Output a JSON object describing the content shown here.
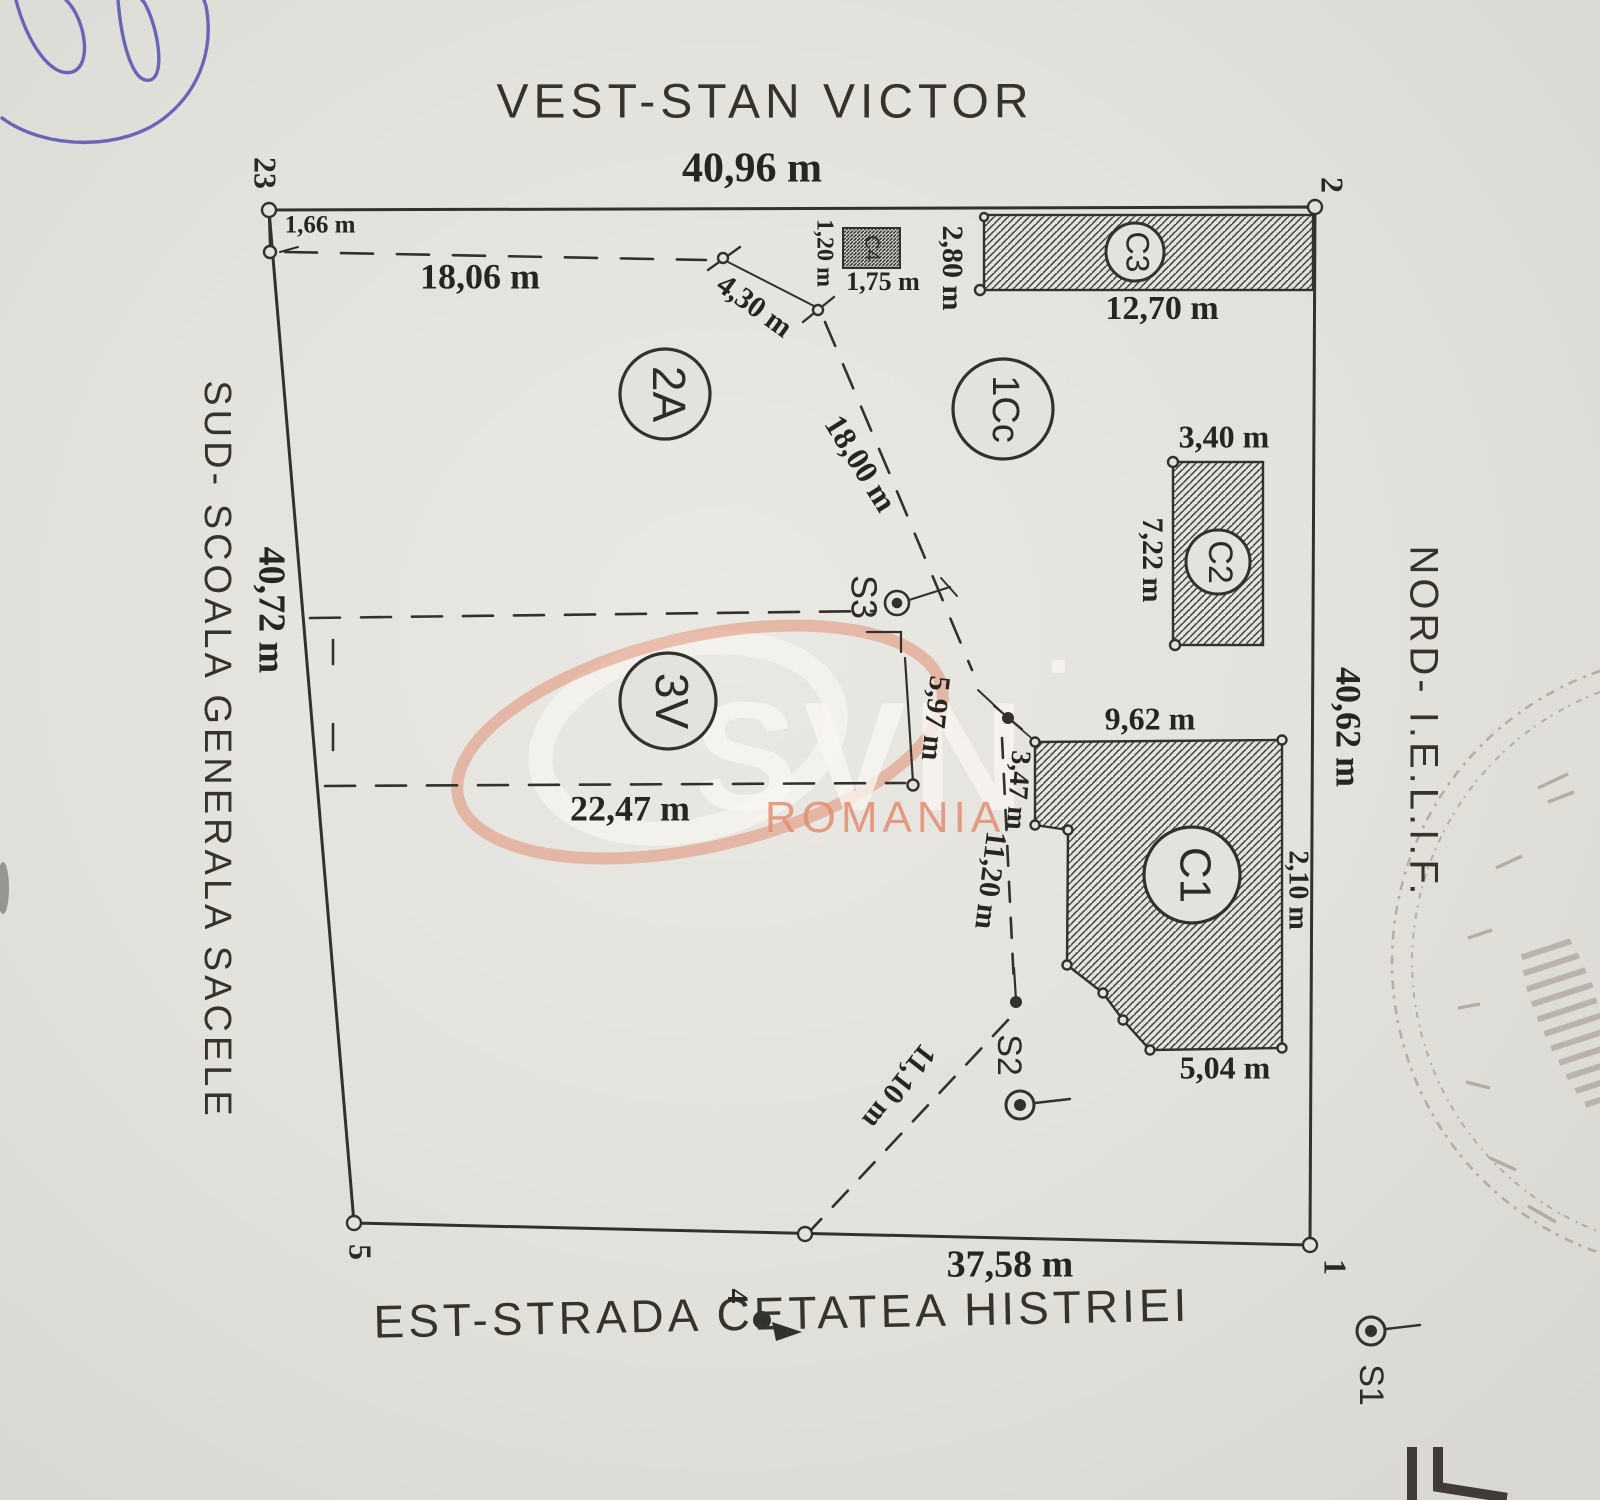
{
  "document": {
    "type_label": "cadastral plan scan",
    "paper_color": "#e3e1dc",
    "ink_color": "#2e2c29",
    "signature_color": "#5550b2",
    "stamp_color": "#7d6c5f",
    "watermark_salmon": "#e28d70"
  },
  "borders": {
    "west": {
      "title": "VEST-STAN VICTOR",
      "length": "40,96 m"
    },
    "sud": {
      "title": "SUD- SCOALA GENERALA SACELE",
      "length": "40,72 m"
    },
    "nord": {
      "title": "NORD- I.E.L.I.F.",
      "length": "40,62 m"
    },
    "est": {
      "title": "EST-STRADA CETATEA HISTRIEI",
      "length": "37,58 m"
    }
  },
  "corners": {
    "c23": "23",
    "c2": "2",
    "c1": "1",
    "c4": "4",
    "c5": "5"
  },
  "parcels": {
    "p2A": "2A",
    "p1Cc": "1Cc",
    "p3V": "3V"
  },
  "constructions": {
    "c1": "C1",
    "c2": "C2",
    "c3": "C3",
    "c4": "C4"
  },
  "stations": {
    "s1": "S1",
    "s2": "S2",
    "s3": "S3"
  },
  "dimensions": {
    "d166": "1,66 m",
    "d1806": "18,06 m",
    "d430": "4,30 m",
    "d120": "1,20 m",
    "d175": "1,75 m",
    "d280": "2,80 m",
    "d1270": "12,70 m",
    "d340": "3,40 m",
    "d722": "7,22 m",
    "d1800": "18,00 m",
    "d597": "5,97 m",
    "d962": "9,62 m",
    "d210": "2,10 m",
    "d347": "3,47 m",
    "d1120": "11,20 m",
    "d2247": "22,47 m",
    "d504": "5,04 m",
    "d1110": "11,10 m"
  },
  "watermark": {
    "brand": "SVN",
    "region": "ROMANIA"
  }
}
